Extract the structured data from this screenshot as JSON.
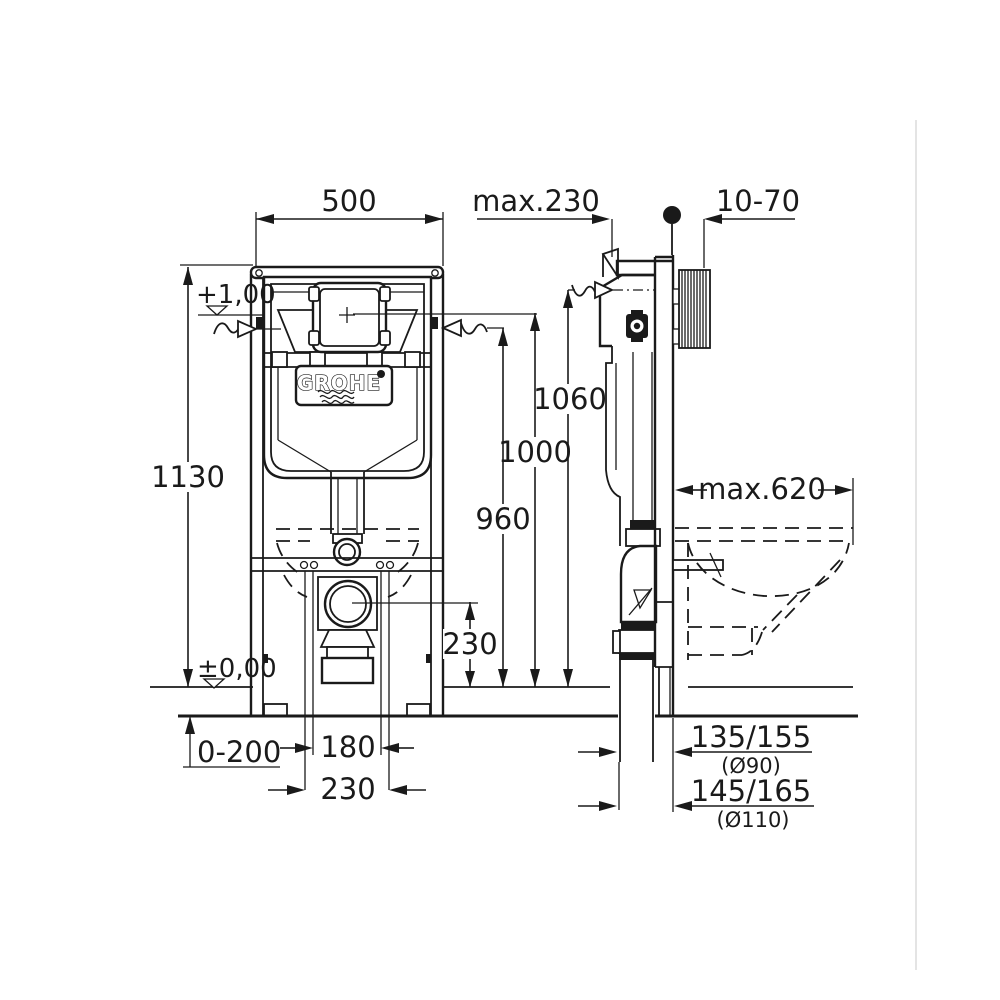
{
  "drawing": {
    "title_hint": "GROHE concealed WC cistern installation frame - dimensional drawing",
    "brand": {
      "name": "GROHE"
    },
    "colors": {
      "line": "#1a1a1a",
      "background": "#ffffff",
      "page_edge": "#e4e4e4"
    },
    "labels": {
      "width_500": "500",
      "max_230": "max.230",
      "wall_10_70": "10-70",
      "level_plus_1_00": "+1,00",
      "height_1130": "1130",
      "height_1060": "1060",
      "height_1000": "1000",
      "height_960": "960",
      "height_230": "230",
      "max_620": "max.620",
      "level_zero": "±0,00",
      "range_0_200": "0-200",
      "spacing_180": "180",
      "spacing_230": "230",
      "outlet_135_155": "135/155",
      "outlet_dia_90": "(Ø90)",
      "outlet_145_165": "145/165",
      "outlet_dia_110": "(Ø110)"
    }
  }
}
